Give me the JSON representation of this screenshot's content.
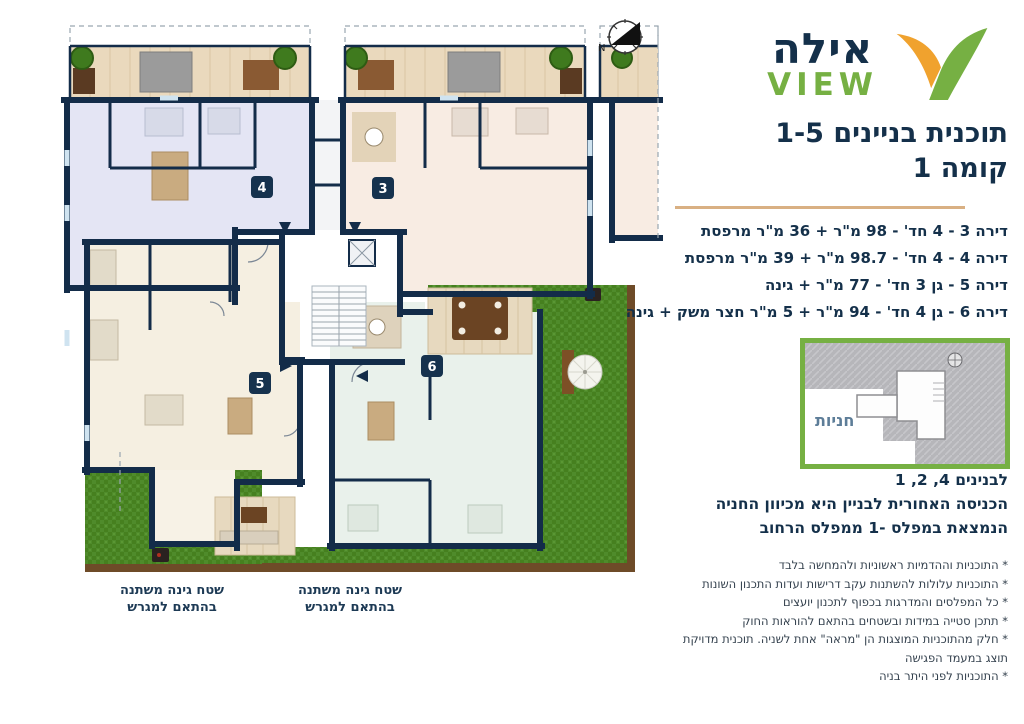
{
  "logo": {
    "hebrew": "אילה",
    "latin": "VIEW",
    "mark_left_color": "#F0A22E",
    "mark_right_color": "#76B043"
  },
  "header": {
    "title_line1": "תוכנית בניינים 1-5",
    "title_line2": "קומה 1"
  },
  "apartments": [
    "דירה 3 - 4 חד' - 98 מ\"ר + 36 מ\"ר מרפסת",
    "דירה 4 - 4 חד' - 98.7 מ\"ר + 39 מ\"ר מרפסת",
    "דירה 5 - גן 3 חד' - 77 מ\"ר + גינה",
    "דירה 6 - גן 4 חד' - 94 מ\"ר + 5 מ\"ר חצר משק + גינה"
  ],
  "minimap": {
    "label": "חניות",
    "border_color": "#76B043"
  },
  "access_note": {
    "line1": "לבנינים 4, 2, 1",
    "line2": "הכניסה האחורית לבניין היא מכיוון החניה",
    "line3": "הנמצאת במפלס -1 ממפלס הרחוב"
  },
  "disclaimers": [
    "* התוכניות וההדמיות ראשוניות ולהמחשה בלבד",
    "* התוכניות עלולות להשתנות עקב דרישות ועדות התכנון השונות",
    "* כל המפלסים והמדרגות בכפוף לתכנון יועצים",
    "* תתכן סטייה במידות ובשטחים בהתאם להוראות החוק",
    "* חלק מהתוכניות המוצגות הן \"מראה\" אחת לשניה. תוכנית מדויקת תוצג במעמד הפגישה",
    "* התוכניות לפני היתר בניה"
  ],
  "plan": {
    "units": [
      {
        "number": "4"
      },
      {
        "number": "3"
      },
      {
        "number": "5"
      },
      {
        "number": "6"
      }
    ],
    "compass_label": "N",
    "garden_labels": [
      {
        "line1": "שטח גינה משתנה",
        "line2": "בהתאם למגרש"
      },
      {
        "line1": "שטח גינה משתנה",
        "line2": "בהתאם למגרש"
      }
    ]
  },
  "colors": {
    "navy": "#14304A",
    "wall": "#132C49",
    "green_brand": "#76B043",
    "orange_brand": "#F0A22E",
    "gold_divider": "#D9B083",
    "grass": "#4F8B2B",
    "apt3_floor": "#F8ECE3",
    "apt4_floor": "#E4E5F4",
    "apt5_floor": "#F5EFE1",
    "apt6_floor": "#E9F1EB",
    "balcony_wood": "#EAD9BD"
  }
}
